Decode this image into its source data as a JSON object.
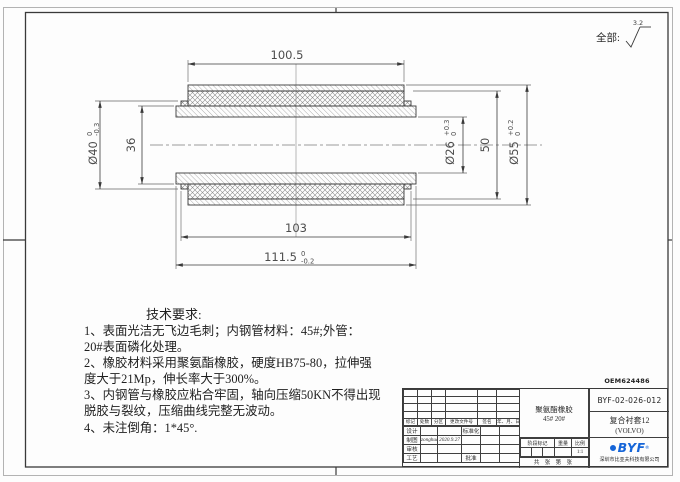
{
  "sheet": {
    "surface_note_label": "全部:",
    "surface_roughness_value": "3.2",
    "code_above_titleblock": "OEM624486"
  },
  "dimensions": {
    "length_outer": "100.5",
    "dia40_main": "Ø40",
    "dia40_tol_up": "0",
    "dia40_tol_dn": "-0.3",
    "dia36": "36",
    "dia26_main": "Ø26",
    "dia26_tol_up": "+0.3",
    "dia26_tol_dn": "0",
    "dia50": "50",
    "dia55_main": "Ø55",
    "dia55_tol_up": "+0.2",
    "dia55_tol_dn": "0",
    "length_rubber": "103",
    "length_total_main": "111.5",
    "length_total_tol_up": "0",
    "length_total_tol_dn": "-0.2"
  },
  "tech_notes": {
    "title": "技术要求:",
    "lines": [
      "1、表面光洁无飞边毛刺；内钢管材料：45#;外管：",
      "20#表面磷化处理。",
      "2、橡胶材料采用聚氨酯橡胶，硬度HB75-80，拉伸强",
      "度大于21Mp，伸长率大于300%。",
      "3、内钢管与橡胶应粘合牢固，轴向压缩50KN不得出现",
      "脱胶与裂纹，压缩曲线完整无波动。",
      "4、未注倒角：1*45°."
    ]
  },
  "titleblock": {
    "rev_headers": [
      "标记",
      "处数",
      "分区",
      "更改文件号",
      "签名",
      "年、月、日"
    ],
    "row_design_label": "设计",
    "row_design_std": "标准化",
    "row_draft_label": "制图",
    "row_draft_sig": "zonghua",
    "row_draft_date": "2020.9.27",
    "row_check_label": "审核",
    "row_process_label": "工艺",
    "row_process_approve": "批准",
    "material_line1": "聚氨酯橡胶",
    "material_line2": "45#  20#",
    "stage_header": "阶段标记",
    "weight_header": "重量",
    "scale_header": "比例",
    "scale_value": "1:1",
    "sheet_count_row": "共 张 第 张",
    "drawing_no": "BYF-02-026-012",
    "part_name": "复合衬套12",
    "part_name_sub": "(VOLVO)",
    "logo_text": "BYF",
    "logo_reg": "®",
    "company": "深圳市比亚夫科技有限公司"
  },
  "colors": {
    "logo_blue": "#1565d8",
    "line": "#3a3a3a"
  }
}
